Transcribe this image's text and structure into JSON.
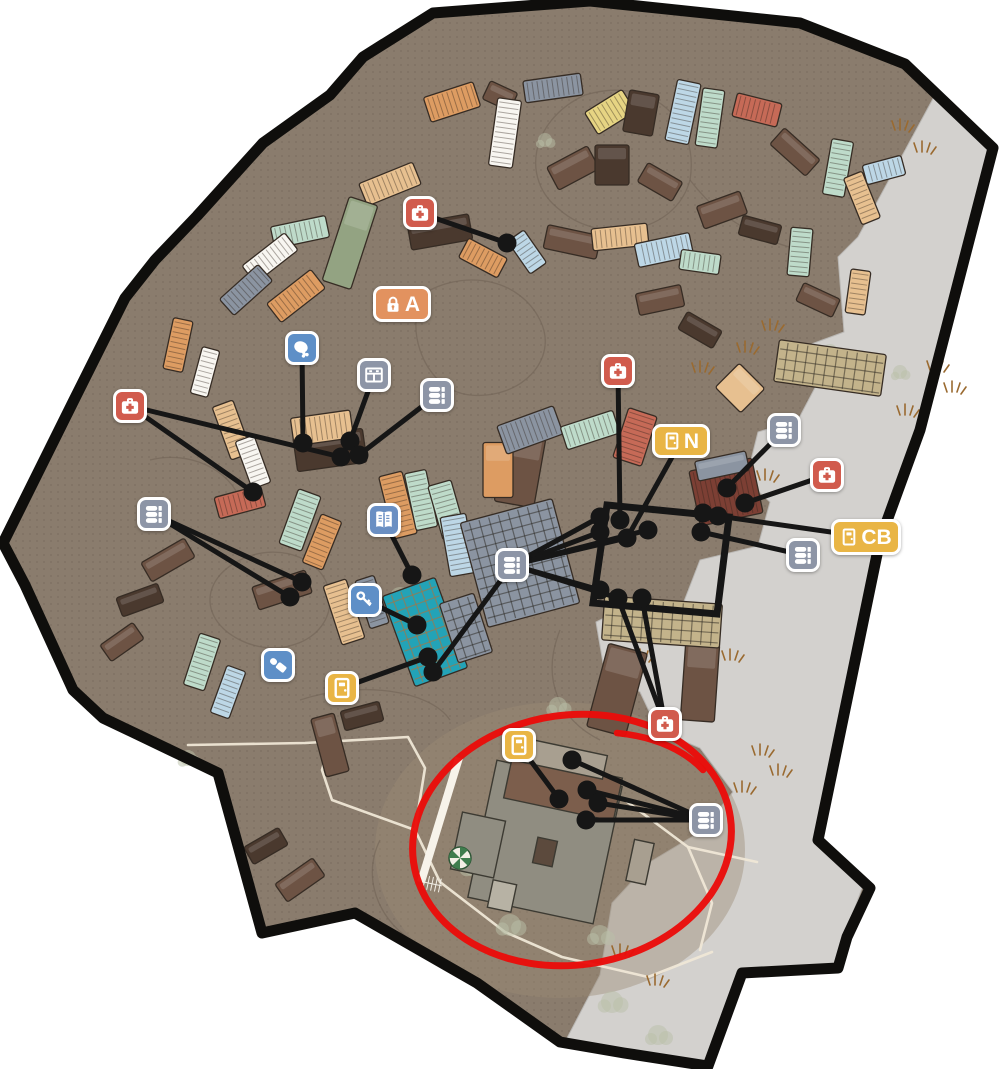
{
  "palette": {
    "ground": "#8a7c6d",
    "outside": "#ffffff",
    "border": "#0f0e0c",
    "gray_area": "#d3d1ce",
    "dot_texture": "#6b5d50",
    "connector": "#161616",
    "red_circle": "#ea0d0a",
    "icon_red": "#d15b4d",
    "icon_blue": "#5e8fc7",
    "icon_book_blue": "#6a8fc3",
    "icon_slate": "#8d95a6",
    "icon_amber": "#e9b545",
    "icon_orange": "#e2925f"
  },
  "colors": {
    "orange": "#dd9c62",
    "peach": "#e7c090",
    "red": "#c66a57",
    "mint": "#bedbca",
    "blue": "#bdd7e6",
    "white": "#f8f6f1",
    "yellow": "#e6d483",
    "green": "#93a382",
    "brown": "#6d5344",
    "darkbrown": "#4a392e",
    "slate": "#8b94a1",
    "darkred": "#7c3f34",
    "tan": "#c3b38b",
    "teal": "#23a3b7",
    "graybldg": "#908d81",
    "deck": "#7c5e4c",
    "roofl": "#a89f90",
    "dark": "#5c4a3d",
    "steps": "#b7b2a4",
    "stripe": "#f7f3ea"
  },
  "map": {
    "outline": "433,13 590,1 800,23 905,64 993,148 920,430 880,540 818,840 870,888 847,937 838,968 742,973 708,1066 624,1053 560,1042 477,983 355,913 262,933 218,773 170,750 103,718 73,690 25,585 3,543 74,400 125,298 155,260 197,216 263,143 330,95 363,57",
    "gray": "935,95 988,150 920,430 880,540 818,840 862,888 845,935 836,966 742,971 706,1062 626,1050 566,1040 600,975 612,903 650,862 700,832 733,792 700,748 658,730 640,692 603,663 596,622 640,600 676,622 700,560 758,546 770,502 746,480 758,432 798,420 818,382 790,352 844,332 838,257 858,237",
    "light_patch": {
      "cx": 560,
      "cy": 850,
      "rx": 185,
      "ry": 148,
      "opacity": 0.42,
      "fill": "#9b8a74"
    }
  },
  "contours": [
    "M560,210 C520,180 530,120 585,95 C650,75 700,120 690,180 C675,235 600,245 560,210 Z",
    "M430,290 C470,270 520,280 540,320 C560,360 520,400 470,395 C420,390 400,315 430,290 Z",
    "M240,560 C280,540 330,560 330,600 C330,640 280,660 240,640 C200,620 200,580 240,560 Z",
    "M300,700 C360,680 430,690 450,720",
    "M150,460 C190,450 230,470 240,500",
    "M380,840 C360,880 380,930 430,950",
    "M690,180 C720,220 760,240 800,250",
    "M560,630 C540,680 560,720 600,740"
  ],
  "shapes": [
    [
      452,
      102,
      52,
      26,
      -18,
      "orange",
      "r"
    ],
    [
      500,
      96,
      30,
      20,
      25,
      "brown",
      "s"
    ],
    [
      553,
      88,
      58,
      22,
      -8,
      "slate",
      "r"
    ],
    [
      610,
      112,
      44,
      26,
      -32,
      "yellow",
      "r"
    ],
    [
      641,
      113,
      30,
      42,
      10,
      "darkbrown",
      "s"
    ],
    [
      683,
      112,
      24,
      62,
      12,
      "blue",
      "r"
    ],
    [
      710,
      118,
      22,
      58,
      8,
      "mint",
      "r"
    ],
    [
      757,
      110,
      46,
      24,
      14,
      "red",
      "r"
    ],
    [
      795,
      152,
      48,
      22,
      42,
      "brown",
      "s"
    ],
    [
      838,
      168,
      22,
      56,
      10,
      "mint",
      "r"
    ],
    [
      862,
      198,
      50,
      20,
      68,
      "peach",
      "r"
    ],
    [
      884,
      170,
      20,
      40,
      75,
      "blue",
      "r"
    ],
    [
      573,
      168,
      46,
      26,
      -28,
      "brown",
      "s"
    ],
    [
      505,
      133,
      24,
      68,
      8,
      "white",
      "r"
    ],
    [
      390,
      184,
      58,
      24,
      -22,
      "peach",
      "r"
    ],
    [
      350,
      243,
      30,
      88,
      18,
      "green",
      "s"
    ],
    [
      300,
      232,
      56,
      22,
      -12,
      "mint",
      "r"
    ],
    [
      270,
      258,
      54,
      22,
      -38,
      "white",
      "r"
    ],
    [
      246,
      290,
      52,
      22,
      -42,
      "slate",
      "r"
    ],
    [
      296,
      296,
      56,
      24,
      -38,
      "orange",
      "r"
    ],
    [
      440,
      232,
      62,
      26,
      -10,
      "darkbrown",
      "s"
    ],
    [
      483,
      258,
      44,
      22,
      28,
      "orange",
      "r"
    ],
    [
      527,
      252,
      40,
      20,
      55,
      "blue",
      "r"
    ],
    [
      572,
      242,
      54,
      24,
      12,
      "brown",
      "s"
    ],
    [
      620,
      237,
      56,
      22,
      -6,
      "peach",
      "r"
    ],
    [
      664,
      250,
      24,
      56,
      78,
      "blue",
      "r"
    ],
    [
      700,
      262,
      40,
      20,
      8,
      "mint",
      "r"
    ],
    [
      612,
      165,
      34,
      40,
      0,
      "darkbrown",
      "s"
    ],
    [
      660,
      182,
      40,
      22,
      30,
      "brown",
      "s"
    ],
    [
      722,
      210,
      46,
      24,
      -20,
      "brown",
      "s"
    ],
    [
      760,
      230,
      40,
      20,
      15,
      "darkbrown",
      "s"
    ],
    [
      800,
      252,
      22,
      48,
      5,
      "mint",
      "r"
    ],
    [
      818,
      300,
      40,
      20,
      25,
      "brown",
      "s"
    ],
    [
      858,
      292,
      20,
      44,
      8,
      "peach",
      "r"
    ],
    [
      178,
      345,
      20,
      52,
      12,
      "orange",
      "r"
    ],
    [
      205,
      372,
      18,
      48,
      15,
      "white",
      "r"
    ],
    [
      232,
      430,
      22,
      56,
      -20,
      "peach",
      "r"
    ],
    [
      253,
      462,
      20,
      50,
      -20,
      "white",
      "r"
    ],
    [
      240,
      502,
      48,
      22,
      -15,
      "red",
      "r"
    ],
    [
      330,
      450,
      70,
      34,
      -8,
      "darkbrown",
      "s"
    ],
    [
      322,
      428,
      60,
      28,
      -8,
      "peach",
      "r"
    ],
    [
      300,
      520,
      24,
      58,
      20,
      "mint",
      "r"
    ],
    [
      322,
      542,
      22,
      52,
      22,
      "orange",
      "r"
    ],
    [
      282,
      590,
      56,
      24,
      -18,
      "brown",
      "s"
    ],
    [
      344,
      612,
      24,
      62,
      -18,
      "peach",
      "r"
    ],
    [
      372,
      602,
      20,
      50,
      -18,
      "slate",
      "r"
    ],
    [
      398,
      505,
      24,
      64,
      -14,
      "orange",
      "r"
    ],
    [
      421,
      500,
      22,
      58,
      -12,
      "mint",
      "r"
    ],
    [
      447,
      510,
      24,
      56,
      -16,
      "mint",
      "r"
    ],
    [
      458,
      545,
      26,
      60,
      -10,
      "blue",
      "r"
    ],
    [
      520,
      470,
      40,
      70,
      10,
      "brown",
      "s"
    ],
    [
      498,
      470,
      30,
      55,
      0,
      "orange",
      "s"
    ],
    [
      530,
      430,
      60,
      30,
      -20,
      "slate",
      "r"
    ],
    [
      590,
      430,
      55,
      24,
      -18,
      "mint",
      "r"
    ],
    [
      635,
      437,
      30,
      52,
      18,
      "red",
      "r"
    ],
    [
      660,
      300,
      46,
      22,
      -12,
      "brown",
      "s"
    ],
    [
      700,
      330,
      40,
      20,
      30,
      "darkbrown",
      "s"
    ],
    [
      740,
      388,
      36,
      34,
      45,
      "peach",
      "s"
    ],
    [
      168,
      560,
      50,
      22,
      -30,
      "brown",
      "s"
    ],
    [
      140,
      600,
      44,
      20,
      -20,
      "darkbrown",
      "s"
    ],
    [
      122,
      642,
      40,
      20,
      -35,
      "brown",
      "s"
    ],
    [
      202,
      662,
      22,
      54,
      18,
      "mint",
      "r"
    ],
    [
      228,
      692,
      20,
      50,
      20,
      "blue",
      "r"
    ],
    [
      330,
      745,
      24,
      60,
      -15,
      "brown",
      "s"
    ],
    [
      362,
      716,
      40,
      20,
      -15,
      "darkbrown",
      "s"
    ],
    [
      300,
      880,
      46,
      22,
      -35,
      "brown",
      "s"
    ],
    [
      266,
      846,
      40,
      20,
      -30,
      "darkbrown",
      "s"
    ],
    [
      617,
      690,
      40,
      86,
      15,
      "brown",
      "s"
    ],
    [
      700,
      682,
      34,
      78,
      4,
      "brown",
      "s"
    ],
    [
      726,
      492,
      64,
      56,
      -12,
      "darkred",
      "r"
    ],
    [
      722,
      466,
      52,
      20,
      -12,
      "slate",
      "s"
    ]
  ],
  "grids": [
    [
      830,
      368,
      108,
      42,
      8,
      "tan"
    ],
    [
      520,
      563,
      95,
      108,
      -15,
      "slate"
    ],
    [
      425,
      632,
      56,
      96,
      -20,
      "teal"
    ],
    [
      466,
      628,
      36,
      62,
      -18,
      "slate"
    ],
    [
      662,
      622,
      118,
      44,
      4,
      "tan"
    ]
  ],
  "bottom_building": [
    [
      440,
      820,
      8,
      130,
      17,
      "stripe"
    ],
    [
      545,
      842,
      128,
      140,
      12,
      "graybldg"
    ],
    [
      563,
      788,
      112,
      44,
      12,
      "deck"
    ],
    [
      556,
      757,
      100,
      24,
      12,
      "roofl"
    ],
    [
      478,
      845,
      44,
      58,
      12,
      "graybldg"
    ],
    [
      545,
      852,
      20,
      26,
      12,
      "dark"
    ],
    [
      640,
      862,
      20,
      42,
      12,
      "roofl"
    ],
    [
      502,
      896,
      24,
      28,
      12,
      "steps"
    ]
  ],
  "carousel": {
    "cx": 460,
    "cy": 858,
    "r": 11,
    "green": "#3f7d4e"
  },
  "fence": {
    "cx": 433,
    "cy": 884,
    "w": 18,
    "h": 14,
    "rot": 12
  },
  "roads": [
    "188,745 305,743 408,737 425,768 415,830 440,882 505,932 562,957 648,977 712,952",
    "562,760 622,798 688,847 712,903 700,950",
    "688,847 757,862",
    "415,830 332,800 322,770 330,742"
  ],
  "grass": [
    [
      900,
      130
    ],
    [
      922,
      152
    ],
    [
      770,
      330
    ],
    [
      745,
      352
    ],
    [
      935,
      370
    ],
    [
      952,
      392
    ],
    [
      765,
      480
    ],
    [
      640,
      660
    ],
    [
      760,
      755
    ],
    [
      778,
      775
    ],
    [
      742,
      792
    ],
    [
      620,
      955
    ],
    [
      655,
      985
    ],
    [
      905,
      415
    ],
    [
      730,
      660
    ],
    [
      700,
      372
    ]
  ],
  "bushes": [
    [
      400,
      597,
      10
    ],
    [
      425,
      615,
      9
    ],
    [
      475,
      865,
      12
    ],
    [
      510,
      925,
      11
    ],
    [
      600,
      935,
      10
    ],
    [
      558,
      706,
      9
    ],
    [
      830,
      352,
      8
    ],
    [
      900,
      372,
      7
    ],
    [
      612,
      1002,
      11
    ],
    [
      658,
      1035,
      10
    ],
    [
      188,
      758,
      8
    ],
    [
      545,
      140,
      7
    ]
  ],
  "black_building": "607,505 729,517 717,614 593,603",
  "red_circle": {
    "cx": 572,
    "cy": 840,
    "rx": 160,
    "ry": 125,
    "rot": -8,
    "tail": "M617,733 C658,737 686,752 703,770"
  },
  "markers": [
    {
      "type": "medkit",
      "x": 420,
      "y": 213
    },
    {
      "type": "lock-badge",
      "x": 402,
      "y": 304,
      "w": 58,
      "h": 36,
      "label": "A"
    },
    {
      "type": "chicken",
      "x": 302,
      "y": 348
    },
    {
      "type": "cabinet",
      "x": 374,
      "y": 375
    },
    {
      "type": "ammo",
      "x": 437,
      "y": 395
    },
    {
      "type": "medkit",
      "x": 130,
      "y": 406
    },
    {
      "type": "ammo",
      "x": 154,
      "y": 514
    },
    {
      "type": "book",
      "x": 384,
      "y": 520
    },
    {
      "type": "key",
      "x": 365,
      "y": 600
    },
    {
      "type": "ammo",
      "x": 512,
      "y": 565
    },
    {
      "type": "suppressor",
      "x": 278,
      "y": 665
    },
    {
      "type": "door",
      "x": 342,
      "y": 688
    },
    {
      "type": "medkit",
      "x": 618,
      "y": 371
    },
    {
      "type": "door-badge",
      "x": 681,
      "y": 441,
      "w": 58,
      "h": 34,
      "label": "N"
    },
    {
      "type": "ammo",
      "x": 784,
      "y": 430
    },
    {
      "type": "medkit",
      "x": 827,
      "y": 475
    },
    {
      "type": "door-badge",
      "x": 866,
      "y": 537,
      "w": 70,
      "h": 36,
      "label": "CB"
    },
    {
      "type": "ammo",
      "x": 803,
      "y": 555
    },
    {
      "type": "medkit",
      "x": 665,
      "y": 724
    },
    {
      "type": "door",
      "x": 519,
      "y": 745
    },
    {
      "type": "ammo",
      "x": 706,
      "y": 820
    }
  ],
  "dots": [
    [
      507,
      243
    ],
    [
      303,
      443
    ],
    [
      350,
      441
    ],
    [
      341,
      457
    ],
    [
      359,
      455
    ],
    [
      253,
      492
    ],
    [
      290,
      597
    ],
    [
      302,
      582
    ],
    [
      412,
      575
    ],
    [
      417,
      625
    ],
    [
      428,
      657
    ],
    [
      433,
      672
    ],
    [
      600,
      517
    ],
    [
      620,
      520
    ],
    [
      600,
      532
    ],
    [
      627,
      538
    ],
    [
      648,
      530
    ],
    [
      600,
      590
    ],
    [
      618,
      598
    ],
    [
      642,
      598
    ],
    [
      703,
      513
    ],
    [
      718,
      516
    ],
    [
      727,
      488
    ],
    [
      745,
      503
    ],
    [
      701,
      532
    ],
    [
      572,
      760
    ],
    [
      587,
      790
    ],
    [
      598,
      803
    ],
    [
      586,
      820
    ],
    [
      559,
      799
    ]
  ],
  "lines": [
    [
      420,
      213,
      507,
      243
    ],
    [
      302,
      348,
      303,
      443
    ],
    [
      374,
      375,
      350,
      441
    ],
    [
      437,
      395,
      359,
      455
    ],
    [
      130,
      406,
      253,
      492
    ],
    [
      130,
      406,
      341,
      457
    ],
    [
      154,
      514,
      290,
      597
    ],
    [
      154,
      514,
      302,
      582
    ],
    [
      384,
      520,
      412,
      575
    ],
    [
      365,
      600,
      417,
      625
    ],
    [
      512,
      565,
      433,
      672
    ],
    [
      512,
      565,
      600,
      517
    ],
    [
      512,
      565,
      600,
      532
    ],
    [
      512,
      565,
      627,
      538
    ],
    [
      512,
      565,
      648,
      530
    ],
    [
      512,
      565,
      600,
      590
    ],
    [
      512,
      565,
      618,
      598
    ],
    [
      342,
      688,
      428,
      657
    ],
    [
      618,
      371,
      620,
      520
    ],
    [
      681,
      441,
      627,
      538
    ],
    [
      784,
      430,
      727,
      488
    ],
    [
      827,
      475,
      745,
      503
    ],
    [
      866,
      537,
      718,
      516
    ],
    [
      803,
      555,
      701,
      532
    ],
    [
      665,
      724,
      618,
      598
    ],
    [
      665,
      724,
      642,
      598
    ],
    [
      519,
      745,
      559,
      799
    ],
    [
      706,
      820,
      572,
      760
    ],
    [
      706,
      820,
      587,
      790
    ],
    [
      706,
      820,
      598,
      803
    ],
    [
      706,
      820,
      586,
      820
    ]
  ]
}
